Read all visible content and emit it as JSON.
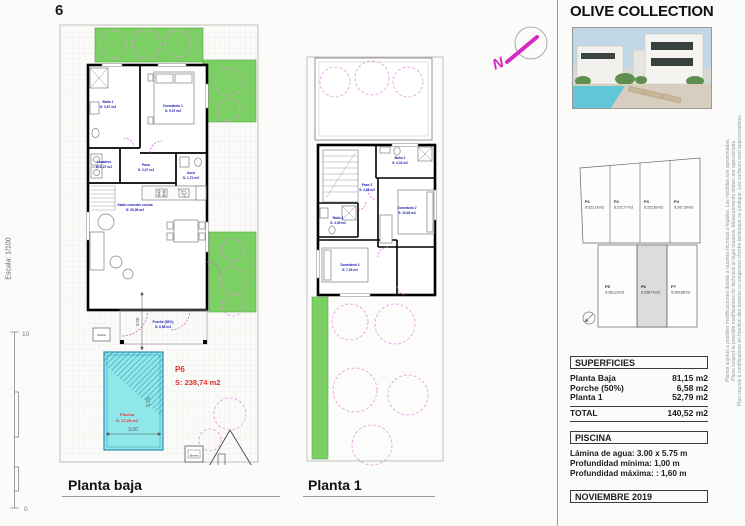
{
  "page": {
    "sheet_number": "6",
    "scale_label": "Escala: 1/100",
    "ruler_top": "10",
    "ruler_bottom": "0"
  },
  "planta_baja": {
    "title": "Planta baja",
    "rooms": {
      "bano1": {
        "name": "Baño 1",
        "area": "S: 3,97 m2"
      },
      "dormitorio1": {
        "name": "Dormitorio 1",
        "area": "S: 9,97 m2"
      },
      "lavadero": {
        "name": "Lavadero",
        "area": "S: 2,07 m2"
      },
      "paso": {
        "name": "Paso",
        "area": "S: 2,47 m2"
      },
      "salon": {
        "name": "Salón comedor cocina",
        "area": "S: 30,05 m2"
      },
      "aseo": {
        "name": "Aseo",
        "area": "S: 1,70 m2"
      },
      "porche": {
        "name": "Porche (50%)",
        "area": "S: 6,58 m2"
      }
    },
    "pool": {
      "name": "Piscina",
      "area": "S: 17,25 m2",
      "width_dim": "3.00",
      "height_dim": "5.75",
      "terrace_dim": "3.05"
    },
    "plot": {
      "id": "P6",
      "area": "S: 238,74 m2"
    },
    "ducha_label": "Ducha",
    "bomba_label": "Bomba"
  },
  "planta1": {
    "title": "Planta 1",
    "rooms": {
      "bano2": {
        "name": "Baño 2",
        "area": "S: 4,03 m2"
      },
      "paso2": {
        "name": "Paso 2",
        "area": "S: 4,68 m2"
      },
      "dormitorio2": {
        "name": "Dormitorio 2",
        "area": "S: 10,65 m2"
      },
      "bano3": {
        "name": "Baño 3",
        "area": "S: 4,05 m2"
      },
      "dormitorio3": {
        "name": "Dormitorio 3",
        "area": "S: 7,04 m2"
      }
    }
  },
  "north": {
    "letter": "N"
  },
  "panel": {
    "title": "OLIVE COLLECTION",
    "site_plots": [
      {
        "id": "P1",
        "area": "S:221,16 m2"
      },
      {
        "id": "P2",
        "area": "S:217,77 m2"
      },
      {
        "id": "P3",
        "area": "S:222,60 m2"
      },
      {
        "id": "P4",
        "area": "S:207,39 m2"
      },
      {
        "id": "P5",
        "area": "S:261,23 m2"
      },
      {
        "id": "P6",
        "area": "S:238,74 m2"
      },
      {
        "id": "P7",
        "area": "S:203,88 m2"
      }
    ],
    "superficies": {
      "title": "SUPERFICIES",
      "rows": [
        {
          "label": "Planta Baja",
          "value": "81,15 m2"
        },
        {
          "label": "Porche (50%)",
          "value": "6,58 m2"
        },
        {
          "label": "Planta 1",
          "value": "52,79 m2"
        }
      ],
      "total_label": "TOTAL",
      "total_value": "140,52 m2"
    },
    "piscina": {
      "title": "PISCINA",
      "line1": "Lámina de agua: 3.00 x 5.75 m",
      "line2": "Profundidad mínima: 1,00 m",
      "line3": "Profundidad máxima: : 1,60 m"
    },
    "date": "NOVIEMBRE 2019",
    "disclaimer_es": "Planos sujetos a posibles modificaciones debido a razones técnicas o legales. Las medidas son aproximadas.",
    "disclaimer_en": "Plans subject to possible modifications for technical or legal reasons. Measurements shown are approximate.",
    "disclaimer_fr": "Plan soumis à modifications en fonction des besoins ou exigences d'ordre technique ou juridique. Les surfaces sont approximatives."
  }
}
